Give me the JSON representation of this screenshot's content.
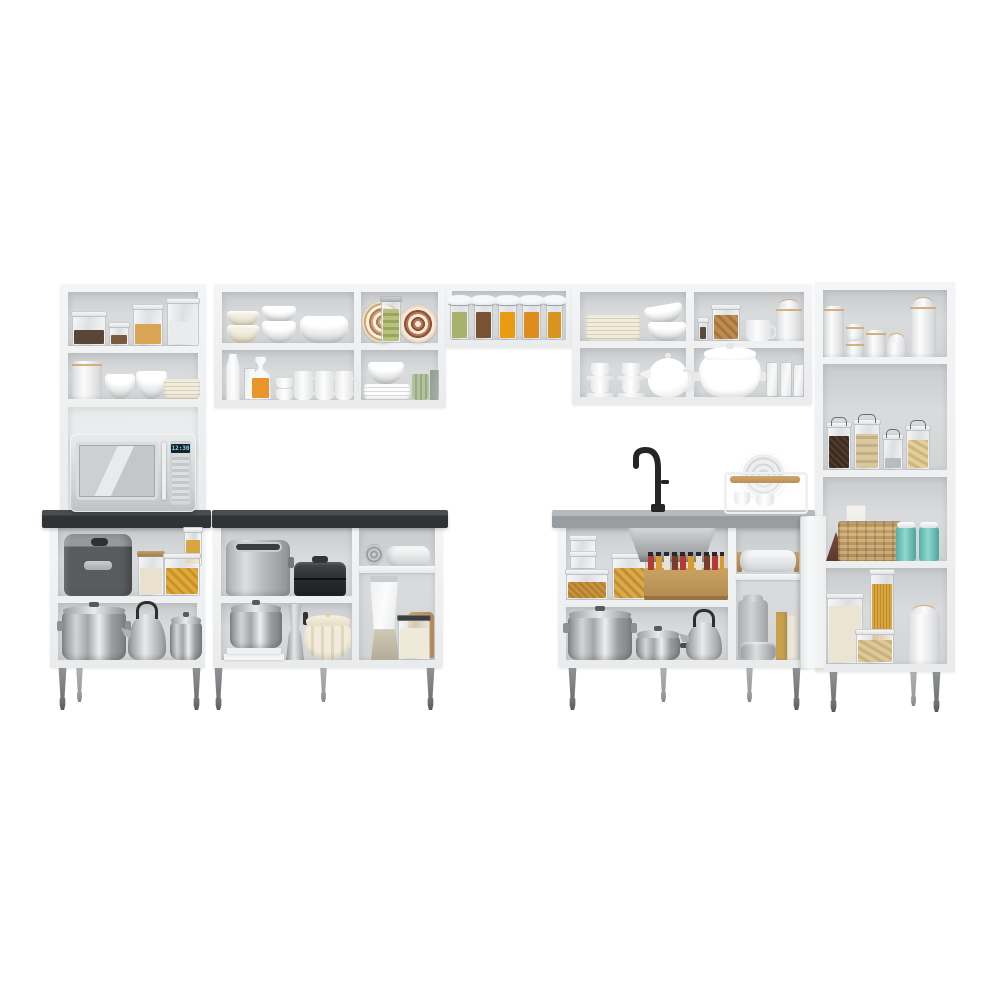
{
  "scene": {
    "title": "White modular kitchen cabinet set with open shelves, product photo on white background",
    "background": "#ffffff",
    "microwave": {
      "clock": "12:30"
    },
    "palette": {
      "cabinet_white": "#f1f2f3",
      "interior_gray": "#d6d8da",
      "countertop_black": "#333537",
      "countertop_gray": "#9ea1a3",
      "leg_gray": "#7c7f82",
      "wood_tan": "#b9925c",
      "basket_tan": "#c0995c",
      "teal_jar": "#6cc2ba",
      "pasta_yellow": "#dca43c",
      "preserve_orange": "#e8950f",
      "pickle_green": "#a9b26a",
      "stainless_steel": "#b3b6b8",
      "cream": "#ece5d2"
    },
    "units": {
      "left_hutch": {
        "top_shelf": [
          "clear jar with dark cereal",
          "small clear jar",
          "jar with corn flakes",
          "tall white storage container"
        ],
        "middle_shelf": [
          "white canister with wood lid",
          "two white bowls",
          "stack of beige plates"
        ],
        "appliance_niche": [
          "microwave oven with digital clock"
        ]
      },
      "upper_cabinet_mid": {
        "top_left": [
          "stack of beige bowls",
          "stack of white bowls",
          "large white serving bowl"
        ],
        "bottom_left": [
          "milk bottle",
          "drinking glass",
          "carafe with orange juice",
          "stacked small cups",
          "three white mugs"
        ],
        "top_right": [
          "decorative patterned plate",
          "glass jar with pickles",
          "second decorative plate"
        ],
        "bottom_right": [
          "stack of white plates with bowl",
          "green ribbed cup",
          "dark glass"
        ]
      },
      "bridge_shelf": {
        "items": [
          "preserve jar with pickles",
          "preserve jar with chutney",
          "preserve jar with orange jam",
          "preserve jar with peach jam",
          "preserve jar with honey"
        ]
      },
      "upper_cabinet_right": {
        "top_left": [
          "stack of ribbed beige plates",
          "two stacked white bowls"
        ],
        "bottom_left": [
          "two stacks of espresso cups with saucers",
          "white teapot"
        ],
        "top_right": [
          "small spice jar",
          "jar with dried cookies",
          "white cup",
          "white canister with gold rim"
        ],
        "bottom_right": [
          "large white soup tureen",
          "three drinking glasses"
        ]
      },
      "tall_cabinet": {
        "shelf_1": [
          "six white ceramic canisters with tan rims"
        ],
        "shelf_2": [
          "wire-bail jar with coffee beans",
          "wire-bail jar with biscuits",
          "small wire-bail jar",
          "wire-bail jar with pasta shells"
        ],
        "shelf_3": [
          "triangular cocoa box",
          "white carton",
          "wicker basket",
          "two teal tins"
        ],
        "shelf_4": [
          "container with rice",
          "tall container with spaghetti",
          "container with pasta shells",
          "white canister with dome lid"
        ]
      },
      "base_cabinet_left": {
        "countertop": "black",
        "top_shelf": [
          "air fryer",
          "glass jar with wood lid",
          "tall jar with yellow pasta",
          "container with yellow pasta"
        ],
        "bottom_shelf": [
          "large steel pot with lid",
          "steel kettle with black handle",
          "steel pot with lid"
        ]
      },
      "base_cabinet_mid": {
        "countertop": "black",
        "top_left": [
          "stainless toaster",
          "black sandwich grill"
        ],
        "bottom_left": [
          "steel pot with lid on white baking dishes",
          "moka coffee maker",
          "cream ribbed dutch oven"
        ],
        "right_column": [
          "rolled gray towel",
          "rolled white towel on mini shelf",
          "blender with glass jar",
          "container with flour",
          "wooden cutting board"
        ]
      },
      "sink_cabinet": {
        "countertop": "gray",
        "on_counter": [
          "black gooseneck faucet",
          "white dish drying rack with ribbed plate, cups and wooden board"
        ],
        "top_left": [
          "two stacked clear containers",
          "container with grains",
          "container with pasta",
          "stainless under-sink basin with drain funnel",
          "wooden spice rack with spice jars"
        ],
        "bottom_left": [
          "large steel stock pot with lid",
          "steel saucepan with lid",
          "steel kettle"
        ],
        "right_column": [
          "white towel on wooden rail",
          "gray canister",
          "two recipe books",
          "steel tin"
        ],
        "open_door": "white door panel open on right side"
      }
    },
    "legs": "tapered gray metal feet under all base units"
  }
}
